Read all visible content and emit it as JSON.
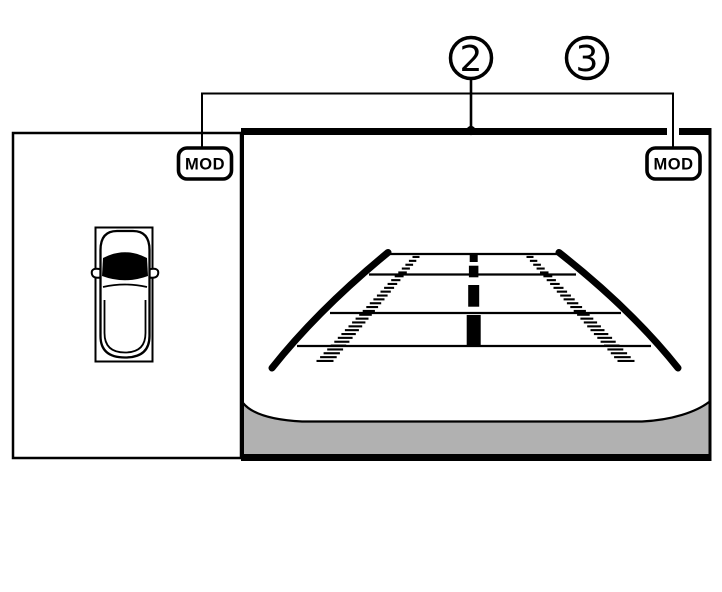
{
  "diagram": {
    "callout_2": {
      "label": "2"
    },
    "callout_3": {
      "label": "3"
    },
    "mod_badge_left": {
      "label": "MOD"
    },
    "mod_badge_right": {
      "label": "MOD"
    },
    "colors": {
      "ink": "#000000",
      "bumper_gray": "#b1b1b1",
      "background": "#ffffff"
    }
  }
}
